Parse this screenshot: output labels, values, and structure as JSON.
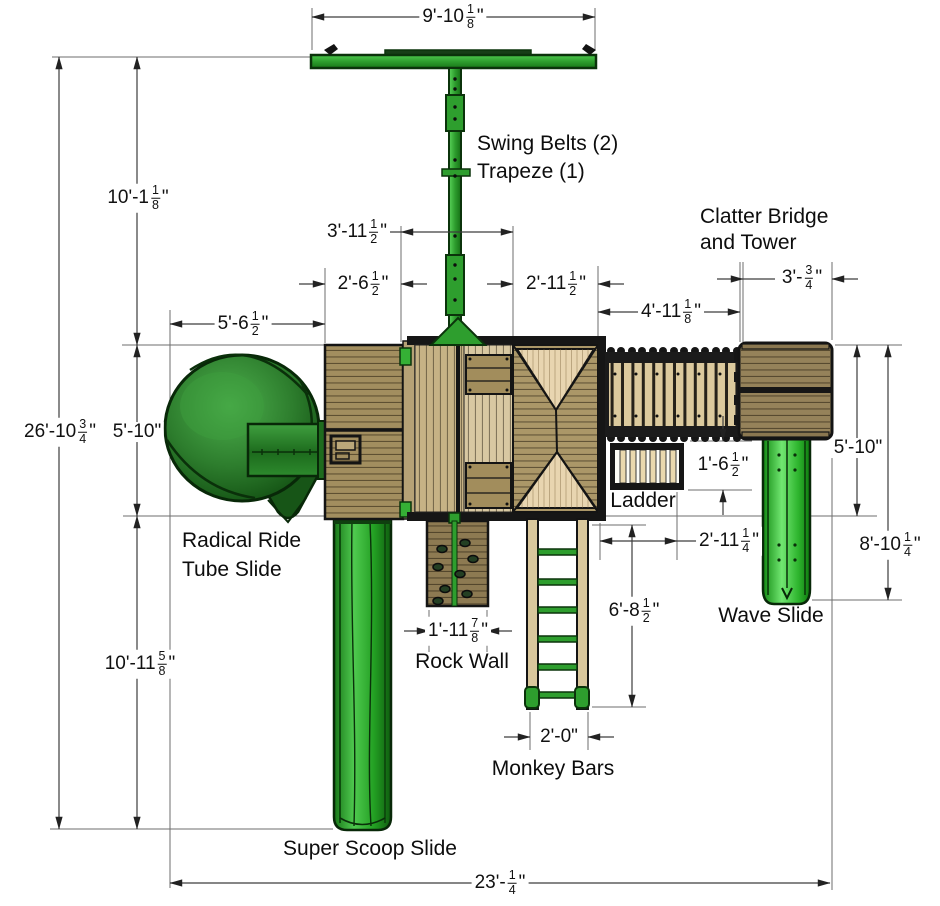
{
  "drawing_title": "Playset Top View Plan",
  "labels": {
    "swing_belts": "Swing Belts (2)",
    "trapeze": "Trapeze (1)",
    "clatter_line1": "Clatter Bridge",
    "clatter_line2": "and Tower",
    "ladder": "Ladder",
    "radical_line1": "Radical Ride",
    "radical_line2": "Tube Slide",
    "rock_wall": "Rock Wall",
    "monkey_bars": "Monkey Bars",
    "wave_slide": "Wave Slide",
    "super_scoop": "Super Scoop Slide"
  },
  "dimensions": {
    "beam_width": "9'-10 1/8\"",
    "swing_drop": "10'-1 1/8\"",
    "total_height": "26'-10 3/4\"",
    "fort_depth_left": "5'-10\"",
    "lower_left": "10'-11 5/8\"",
    "fort_left_offset": "5'-6 1/2\"",
    "deck_left": "2'-6 1/2\"",
    "deck_mid": "3'-11 1/2\"",
    "deck_roof": "2'-11 1/2\"",
    "bridge_len": "4'-11 1/8\"",
    "tower_w": "3'- 3/4\"",
    "tower_depth": "5'-10\"",
    "ladder_depth": "1'-6 1/2\"",
    "ladder_offset": "2'-11 1/4\"",
    "wave_len": "8'-10 1/4\"",
    "monkey_len": "6'-8 1/2\"",
    "monkey_w": "2'-0\"",
    "rock_w": "1'-11 7/8\"",
    "total_w": "23'- 1/4\""
  },
  "colors": {
    "slide_green": "#2e9e2e",
    "green_dark": "#1d6b1d",
    "wood_light": "#d9c79c",
    "wood_mid": "#a28e5f",
    "wood_dark": "#95825a",
    "outline": "#141414",
    "dim_line": "#3d3d3d",
    "text": "#111111"
  }
}
